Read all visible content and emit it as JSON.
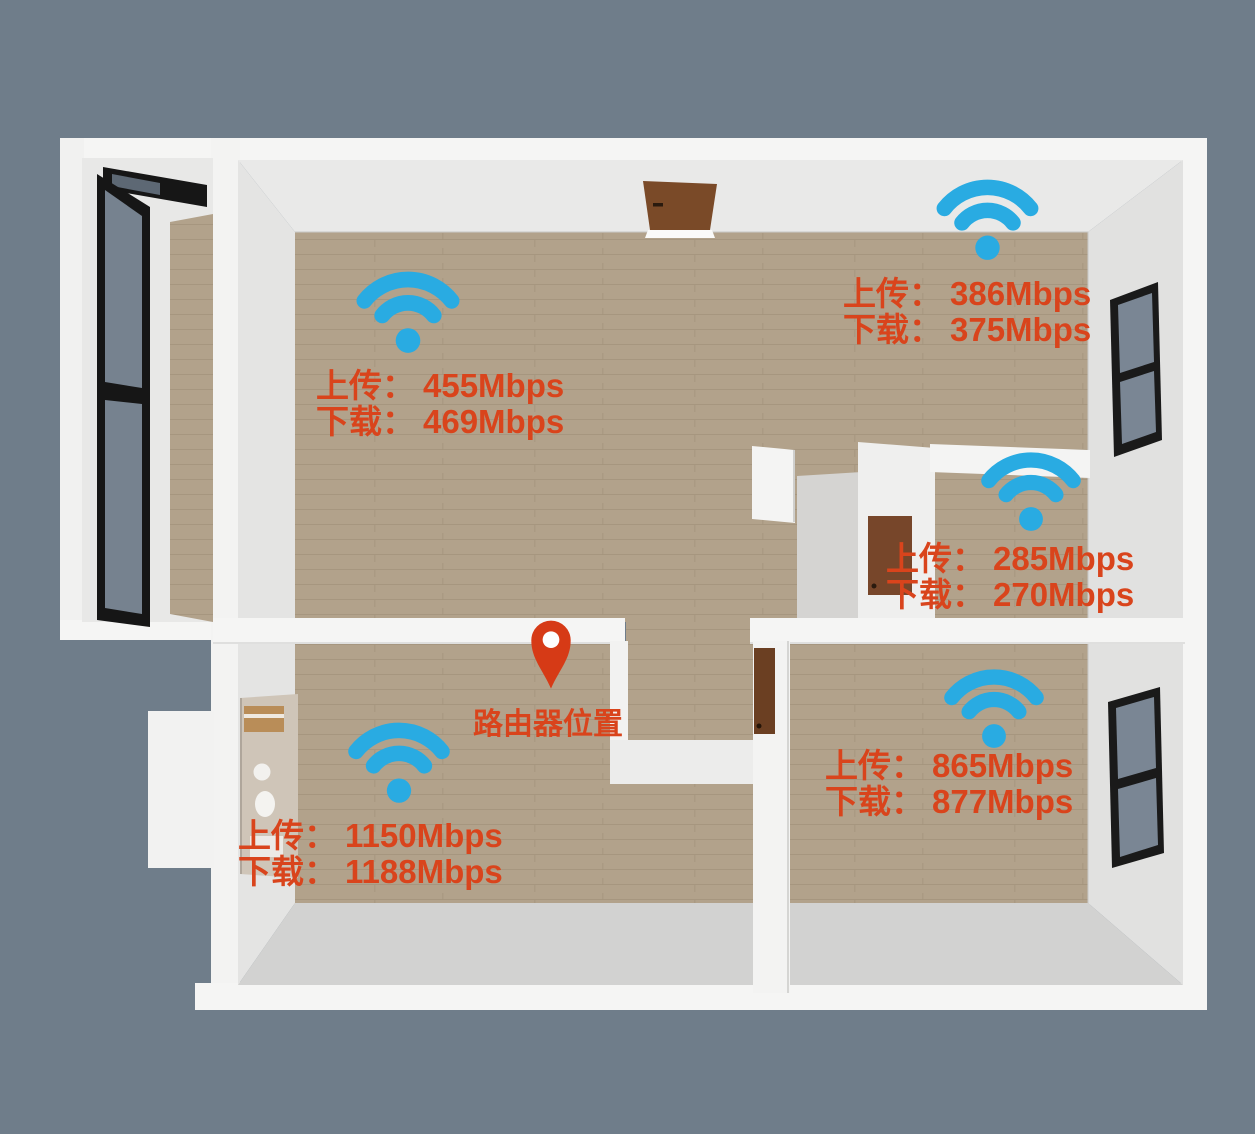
{
  "scene": {
    "type": "apartment-floor-plan-wifi-coverage",
    "background_color": "#6F7D8A"
  },
  "colors": {
    "wifi_icon": "#29ABE2",
    "annotation_text": "#D9441C",
    "router_pin": "#D63A16",
    "wall_white": "#F5F5F4",
    "wall_face_gray": "#E6E6E5",
    "floor_wood": "#B2A28B",
    "floor_gray": "#D2D2D1",
    "door_brown": "#7A4A28",
    "window_frame": "#161616"
  },
  "router": {
    "label": "路由器位置"
  },
  "measurements": [
    {
      "location": "upper-left-room",
      "upload_label": "上传：",
      "upload_value": "455Mbps",
      "download_label": "下载：",
      "download_value": "469Mbps",
      "upload_mbps": 455,
      "download_mbps": 469
    },
    {
      "location": "upper-right-area",
      "upload_label": "上传：",
      "upload_value": "386Mbps",
      "download_label": "下载：",
      "download_value": "375Mbps",
      "upload_mbps": 386,
      "download_mbps": 375
    },
    {
      "location": "middle-right-room",
      "upload_label": "上传：",
      "upload_value": "285Mbps",
      "download_label": "下载：",
      "download_value": "270Mbps",
      "upload_mbps": 285,
      "download_mbps": 270
    },
    {
      "location": "lower-right-room",
      "upload_label": "上传：",
      "upload_value": "865Mbps",
      "download_label": "下载：",
      "download_value": "877Mbps",
      "upload_mbps": 865,
      "download_mbps": 877
    },
    {
      "location": "lower-left-room",
      "upload_label": "上传：",
      "upload_value": "1150Mbps",
      "download_label": "下载：",
      "download_value": "1188Mbps",
      "upload_mbps": 1150,
      "download_mbps": 1188
    }
  ]
}
